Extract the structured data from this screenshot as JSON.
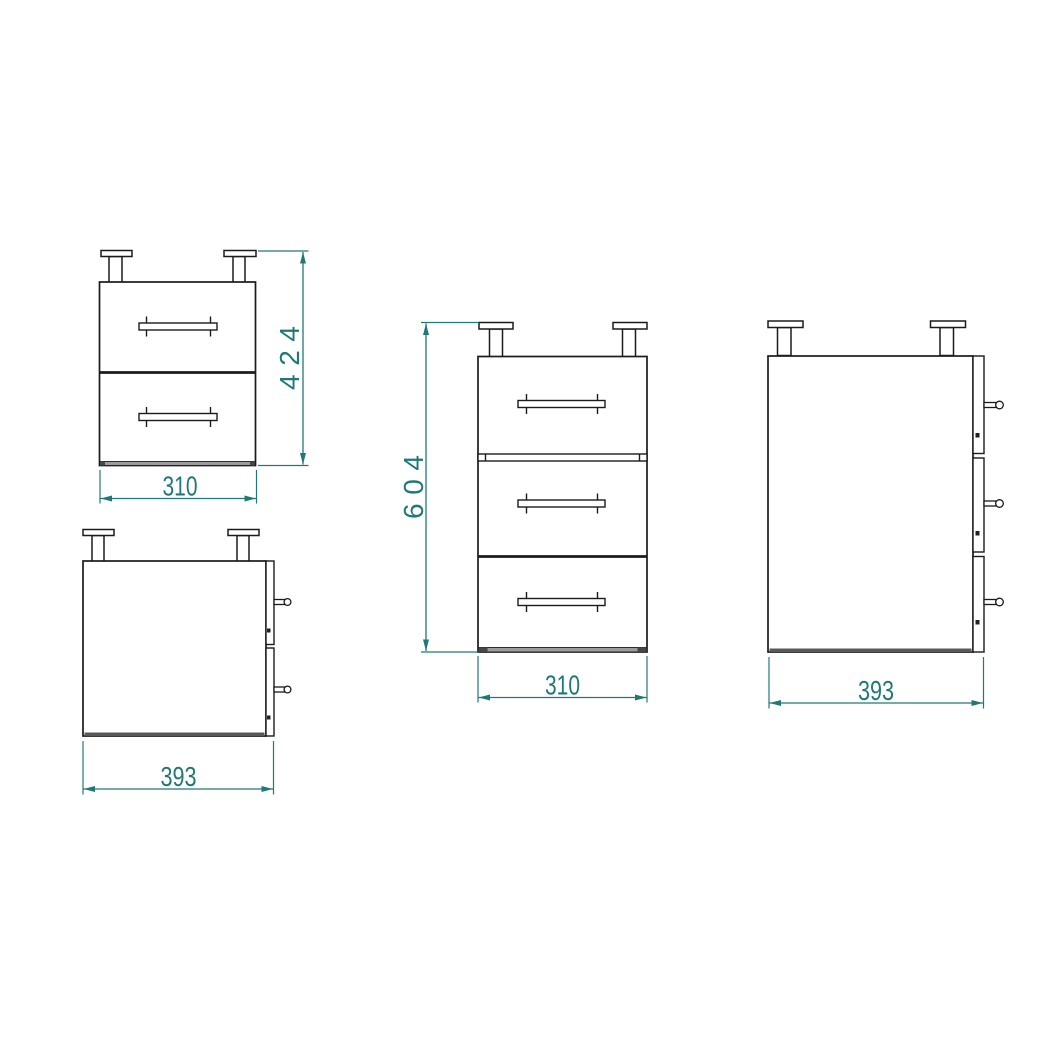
{
  "colors": {
    "background": "#ffffff",
    "line": "#1b1b1b",
    "dimension": "#207976",
    "bottom_panel": "#9b9b9b"
  },
  "views": {
    "front_two_drawer": {
      "height_label": "424",
      "width_label": "310"
    },
    "side_two_drawer": {
      "depth_label": "393"
    },
    "front_three_drawer": {
      "height_label": "604",
      "width_label": "310"
    },
    "side_three_drawer": {
      "depth_label": "393"
    }
  }
}
